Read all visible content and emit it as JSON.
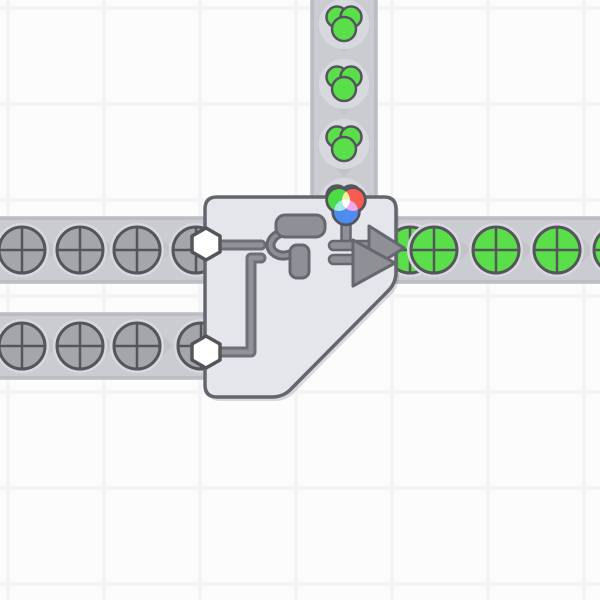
{
  "scene": {
    "canvas": {
      "width": 600,
      "height": 600
    },
    "grid": {
      "offset": 8,
      "step": 96,
      "line_width": 4
    },
    "belts": [
      {
        "id": "belt-left-top",
        "direction": "right",
        "x": 0,
        "y": 216,
        "w": 212,
        "h": 68
      },
      {
        "id": "belt-left-bottom",
        "direction": "right",
        "x": 0,
        "y": 312,
        "w": 212,
        "h": 68
      },
      {
        "id": "belt-vertical",
        "direction": "down",
        "x": 310,
        "y": 0,
        "w": 68,
        "h": 212
      },
      {
        "id": "belt-right",
        "direction": "right",
        "x": 384,
        "y": 216,
        "w": 216,
        "h": 68
      }
    ],
    "chevrons": {
      "down": [
        [
          344,
          46
        ],
        [
          344,
          108
        ],
        [
          344,
          170
        ]
      ],
      "right": [
        [
          51,
          250
        ],
        [
          108,
          250
        ],
        [
          166,
          250
        ],
        [
          51,
          346
        ],
        [
          108,
          346
        ],
        [
          166,
          346
        ],
        [
          464,
          250
        ],
        [
          526,
          250
        ],
        [
          588,
          250
        ]
      ]
    },
    "items": {
      "gray_circles": [
        [
          22,
          250
        ],
        [
          80,
          250
        ],
        [
          137,
          250
        ],
        [
          196,
          250
        ],
        [
          22,
          346
        ],
        [
          80,
          346
        ],
        [
          137,
          346
        ],
        [
          201,
          346
        ]
      ],
      "green_circles": [
        [
          410,
          250
        ],
        [
          434,
          250
        ],
        [
          496,
          250
        ],
        [
          557,
          250
        ],
        [
          617,
          250
        ]
      ],
      "green_color_blobs": [
        [
          344,
          24
        ],
        [
          344,
          84
        ],
        [
          344,
          144
        ],
        [
          344,
          203
        ]
      ]
    },
    "building": {
      "type": "painter-double",
      "shape_inputs": 2,
      "input_item": "uncolored-circle",
      "color_input_item": "green-color",
      "output_item": "green-circle",
      "output_direction": "right"
    }
  },
  "palette": {
    "bg": "#fcfcfd",
    "grid_line": "#f4f4f6",
    "belt": "#cbccd2",
    "belt_edge": "#bbbdc3",
    "chevron": "#c2c4ca",
    "halo": "#d8d9de",
    "item_gray": "#a5a6aa",
    "item_outline": "#54565c",
    "item_green": "#5ade49",
    "blob_green": "#5ade49",
    "building_fill": "#e5e6eb",
    "building_border": "#63666c",
    "building_shadow": "rgba(100,102,110,0.22)",
    "hex_fill": "#ffffff",
    "hex_border": "#53555b",
    "icon_fill": "#8e9096",
    "icon_outline": "#65686e",
    "pipe_outer": "#6e7076",
    "pipe_inner": "#90929a",
    "wheel_outline": "#53555b",
    "wheel_red": "#f85b50",
    "wheel_green": "#4cdc46",
    "wheel_blue": "#4f8cf2",
    "wheel_yellow": "#eef2a0",
    "wheel_cyan": "#a5ecdf",
    "wheel_magenta": "#f3a6ea",
    "wheel_center": "#ffffff"
  }
}
